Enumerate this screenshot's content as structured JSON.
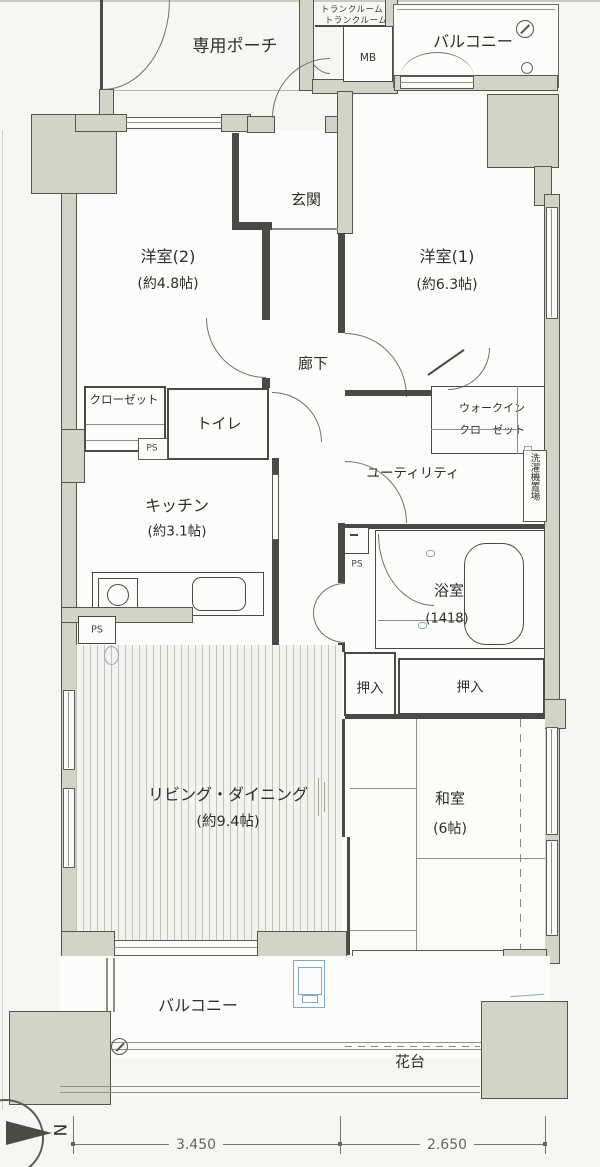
{
  "labels": {
    "porch": "専用ポーチ",
    "trunk_room_line1": "トランクルーム",
    "trunk_room_line2": "トランクルーム",
    "mb": "MB",
    "balcony_top": "バルコニー",
    "entrance": "玄関",
    "hallway": "廊下",
    "closet": "クローゼット",
    "toilet": "トイレ",
    "walk_in_closet_line1": "ウォークイン",
    "walk_in_closet_line2": "クローゼット",
    "utility": "ユーティリティ",
    "washer_space": "洗濯機置場",
    "ps": "PS",
    "oshiire": "押入",
    "balcony_bottom": "バルコニー",
    "flower_bed": "花台"
  },
  "rooms": [
    {
      "name": "洋室(2)",
      "size": "(約4.8帖)"
    },
    {
      "name": "洋室(1)",
      "size": "(約6.3帖)"
    },
    {
      "name": "キッチン",
      "size": "(約3.1帖)"
    },
    {
      "name": "浴室",
      "size": "(1418)"
    },
    {
      "name": "リビング・ダイニング",
      "size": "(約9.4帖)"
    },
    {
      "name": "和室",
      "size": "(6帖)"
    }
  ],
  "dimensions": {
    "width_left": "3.450",
    "width_right": "2.650"
  },
  "compass": {
    "letter": "N"
  },
  "colors": {
    "wall_fill": "#d2d4c8",
    "line_dark": "#4a4a44",
    "accent_blue": "#82aacb",
    "paper": "#f6f6f2"
  }
}
